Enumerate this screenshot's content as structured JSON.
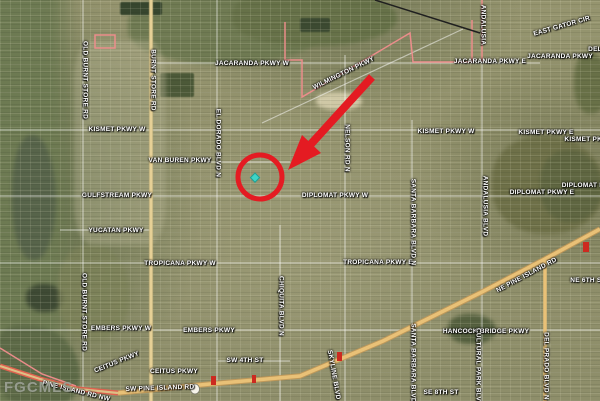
{
  "watermark": {
    "text": "FGCMLS"
  },
  "colors": {
    "annotation_red": "#e41b22",
    "marker_teal": "#3ed4c6",
    "highway_yellow": "#e9c177",
    "road_yellow": "#e6d096",
    "boundary_pink": "#f08d8d",
    "watermark_grey": "#9ba194"
  },
  "map": {
    "type": "satellite-aerial",
    "road_labels": [
      {
        "text": "JACARANDA PKWY W",
        "x": 252,
        "y": 64,
        "rot": 0
      },
      {
        "text": "JACARANDA PKWY E",
        "x": 490,
        "y": 62,
        "rot": 0
      },
      {
        "text": "JACARANDA PKWY",
        "x": 560,
        "y": 57,
        "rot": 0
      },
      {
        "text": "EAST GATOR CIR",
        "x": 562,
        "y": 27,
        "rot": -16
      },
      {
        "text": "WILMINGTON PKWY",
        "x": 344,
        "y": 74,
        "rot": -26
      },
      {
        "text": "KISMET PKWY W",
        "x": 117,
        "y": 130,
        "rot": 0
      },
      {
        "text": "KISMET PKWY W",
        "x": 446,
        "y": 132,
        "rot": 0
      },
      {
        "text": "KISMET PKWY E",
        "x": 546,
        "y": 133,
        "rot": 0
      },
      {
        "text": "KISMET PKWY E",
        "x": 592,
        "y": 140,
        "rot": 0
      },
      {
        "text": "VAN BUREN PKWY",
        "x": 180,
        "y": 161,
        "rot": 0
      },
      {
        "text": "GULFSTREAM PKWY",
        "x": 117,
        "y": 196,
        "rot": 0
      },
      {
        "text": "DIPLOMAT PKWY W",
        "x": 335,
        "y": 196,
        "rot": 0
      },
      {
        "text": "DIPLOMAT PKWY E",
        "x": 542,
        "y": 193,
        "rot": 0
      },
      {
        "text": "DIPLOMAT PKWY E",
        "x": 594,
        "y": 186,
        "rot": 0
      },
      {
        "text": "YUCATAN PKWY",
        "x": 116,
        "y": 231,
        "rot": 0
      },
      {
        "text": "TROPICANA PKWY W",
        "x": 180,
        "y": 264,
        "rot": 0
      },
      {
        "text": "TROPICANA PKWY E",
        "x": 378,
        "y": 263,
        "rot": 0
      },
      {
        "text": "EMBERS PKWY W",
        "x": 121,
        "y": 329,
        "rot": 0
      },
      {
        "text": "EMBERS PKWY",
        "x": 209,
        "y": 331,
        "rot": 0
      },
      {
        "text": "SW 4TH ST",
        "x": 245,
        "y": 361,
        "rot": 0
      },
      {
        "text": "SE 8TH ST",
        "x": 441,
        "y": 393,
        "rot": 0
      },
      {
        "text": "HANCOCK BRIDGE PKWY",
        "x": 486,
        "y": 332,
        "rot": 0
      },
      {
        "text": "CEITUS PKWY",
        "x": 117,
        "y": 363,
        "rot": -22
      },
      {
        "text": "CEITUS PKWY",
        "x": 174,
        "y": 372,
        "rot": 0
      },
      {
        "text": "SW PINE ISLAND RD",
        "x": 160,
        "y": 389,
        "rot": -2
      },
      {
        "text": "PINE ISLAND RD NW",
        "x": 76,
        "y": 392,
        "rot": 14
      },
      {
        "text": "NE PINE ISLAND RD",
        "x": 527,
        "y": 276,
        "rot": -28
      },
      {
        "text": "NE 6TH ST",
        "x": 588,
        "y": 281,
        "rot": 0
      },
      {
        "text": "DEL",
        "x": 595,
        "y": 50,
        "rot": 0
      },
      {
        "text": "OLD BURNT STORE RD",
        "x": 84,
        "y": 80,
        "rot": 90
      },
      {
        "text": "OLD BURNT STORE RD",
        "x": 83,
        "y": 312,
        "rot": 90
      },
      {
        "text": "BURNT STORE RD",
        "x": 152,
        "y": 80,
        "rot": 90
      },
      {
        "text": "EL DORADO BLVD N",
        "x": 217,
        "y": 143,
        "rot": 90
      },
      {
        "text": "NELSON RD N",
        "x": 346,
        "y": 148,
        "rot": 90
      },
      {
        "text": "ANDALUSIA",
        "x": 482,
        "y": 25,
        "rot": 90
      },
      {
        "text": "ANDALUSIA BLVD",
        "x": 484,
        "y": 206,
        "rot": 90
      },
      {
        "text": "SANTA BARBARA BLVD N",
        "x": 412,
        "y": 222,
        "rot": 90
      },
      {
        "text": "SANTA BARBARA BLVD",
        "x": 412,
        "y": 363,
        "rot": 90
      },
      {
        "text": "CULTURAL PARK BLVD",
        "x": 477,
        "y": 367,
        "rot": 90
      },
      {
        "text": "CHIQUITA BLVD N",
        "x": 280,
        "y": 306,
        "rot": 90
      },
      {
        "text": "DEL PRADO BLVD N",
        "x": 545,
        "y": 366,
        "rot": 90
      },
      {
        "text": "SKYLINE BLVD",
        "x": 333,
        "y": 375,
        "rot": 80
      }
    ]
  }
}
